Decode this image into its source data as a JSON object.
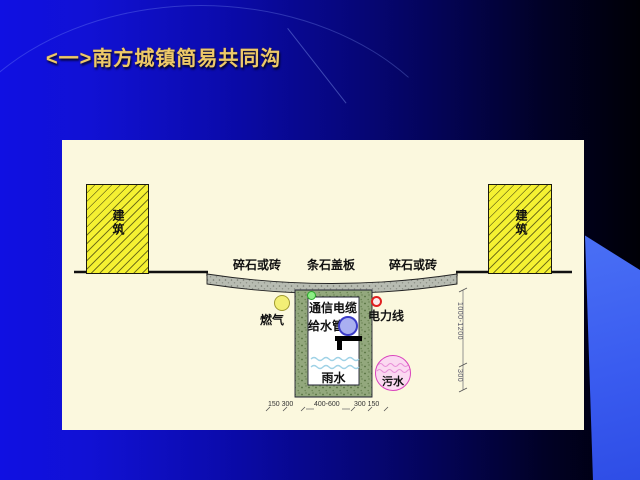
{
  "slide": {
    "title": "<一>南方城镇简易共同沟"
  },
  "diagram": {
    "building_left": "建筑",
    "building_right": "建筑",
    "surface": {
      "left": "碎石或砖",
      "center": "条石盖板",
      "right": "碎石或砖"
    },
    "utilities": {
      "gas": "燃气",
      "telecom": "通信电缆",
      "water_supply": "给水管",
      "power": "电力线",
      "rainwater": "雨水",
      "sewage": "污水"
    },
    "dimensions": {
      "depth_main": "1000-1200",
      "depth_bottom": "300",
      "width_left": "150 300",
      "width_center": "400-600",
      "width_right": "300 150"
    },
    "colors": {
      "background_left": "#1010E2",
      "background_right": "#000006",
      "swoosh": "#3A5CF0",
      "title": "#EEC96A",
      "panel": "#FBF8DE",
      "building": "#F5F132",
      "road": "#B8BCB2",
      "trench_wall": "#93A87D",
      "gas": "#F3EF76",
      "telecom": "#8DEE85",
      "water": "#A9AFF1",
      "power": "#E02020",
      "sewage": "#FBD9F1",
      "wave": "#9FD2E6"
    }
  }
}
